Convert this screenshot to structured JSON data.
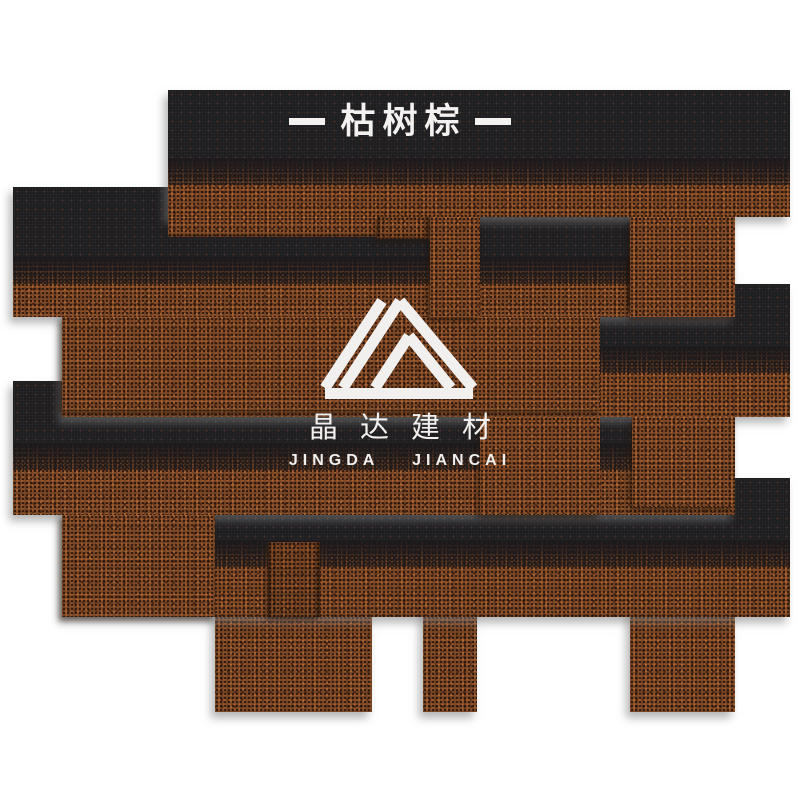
{
  "banner": {
    "title": "枯树棕"
  },
  "logo": {
    "mark": "mountain-peaks-logo",
    "name_cn": "晶达建材",
    "name_en": "JINGDA JIANCAI"
  },
  "colors": {
    "background": "#ffffff",
    "granule_brown": "#7a4827",
    "granule_orange_fleck": "#be642c",
    "asphalt_black": "#1c1b1e",
    "text_white": "#f3f2f0",
    "shadow_gray": "#7c7c7c"
  }
}
